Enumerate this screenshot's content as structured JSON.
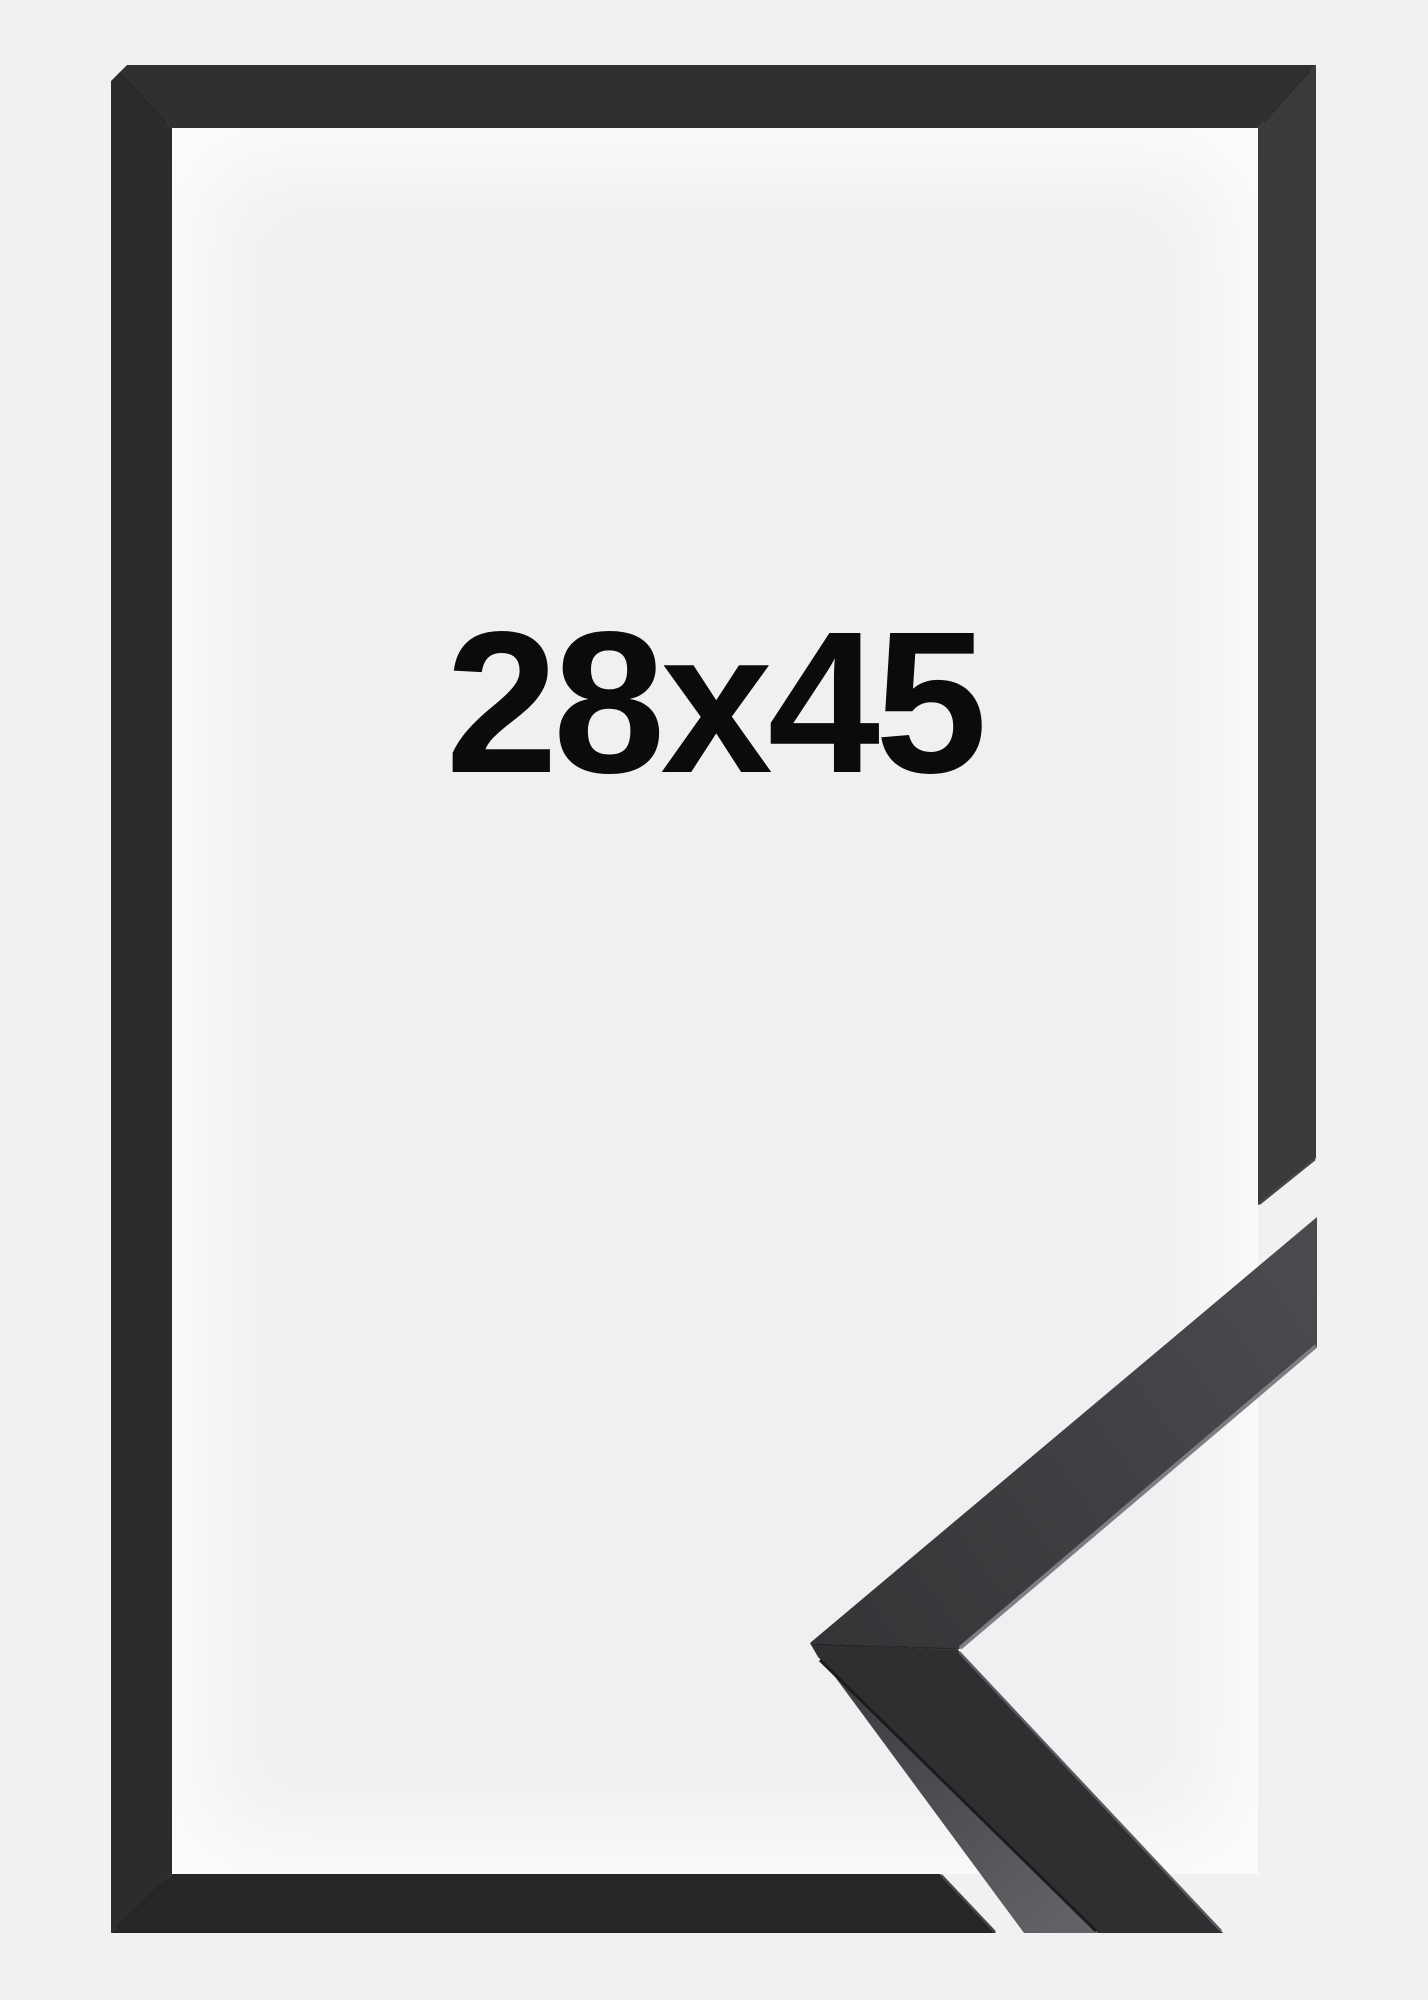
{
  "product": {
    "type": "picture-frame",
    "size_label": "28x45",
    "finish": "black"
  },
  "colors": {
    "bg": "#f1f1f2",
    "inner_bg": "#f0f0f2",
    "label_color": "#0b0b0b",
    "border_top": "#303032",
    "border_left": "#2c2c2e",
    "border_right": "#3a3a3d",
    "border_bottom": "#262629",
    "cut_bevel": "#47474b",
    "arm_dark_start": "#343437",
    "arm_dark_end": "#4b4b4f",
    "front_face": "#2f2f32",
    "side_face_top": "#38383b",
    "side_face_bottom": "#626267",
    "highlight": "#7d7d82",
    "highlight_dim": "#5a5a5e",
    "crease": "#1b1b1d",
    "seam": "rgba(0,0,0,0.3)"
  }
}
